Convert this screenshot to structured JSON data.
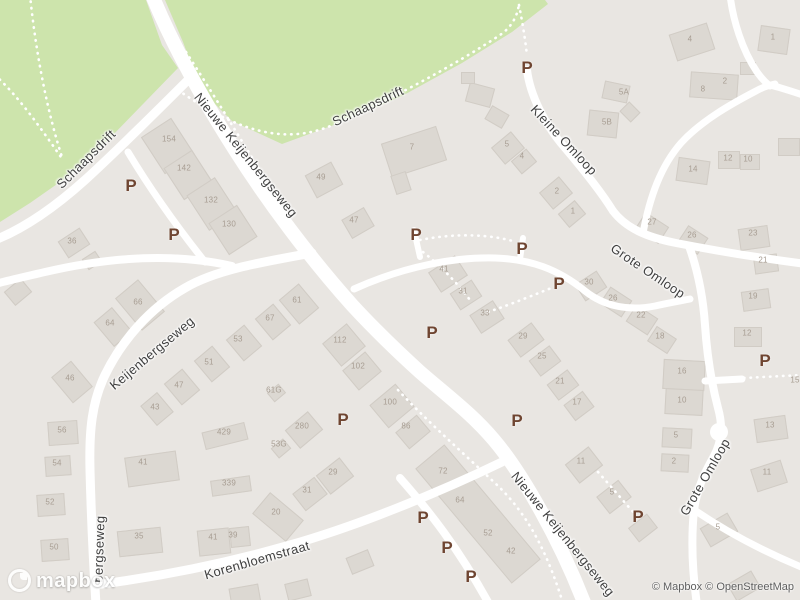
{
  "map": {
    "provider_logo": "mapbox",
    "attribution": "© Mapbox © OpenStreetMap",
    "colors": {
      "park": "#cde4ac",
      "background": "#e9e6e2",
      "road": "#ffffff",
      "building": "#dcd8d2",
      "building_outline": "#d1ccc5",
      "parking_icon": "#6f4531",
      "street_label": "#3f3f3f",
      "house_number": "#a79d92",
      "attribution": "#5f5f5f"
    },
    "streets": [
      {
        "t": "Schaapsdrift",
        "x": 86,
        "y": 159,
        "r": -45,
        "s": 13
      },
      {
        "t": "Nieuwe Keijenbergseweg",
        "x": 246,
        "y": 155,
        "r": 51,
        "s": 13
      },
      {
        "t": "Schaapsdrift",
        "x": 368,
        "y": 106,
        "r": -25,
        "s": 13
      },
      {
        "t": "Kleine Omloop",
        "x": 564,
        "y": 140,
        "r": 47,
        "s": 13
      },
      {
        "t": "Grote Omloop",
        "x": 648,
        "y": 271,
        "r": 34,
        "s": 13
      },
      {
        "t": "Keijenbergseweg",
        "x": 152,
        "y": 353,
        "r": -40,
        "s": 13
      },
      {
        "t": "bergseweg",
        "x": 99,
        "y": 549,
        "r": -88,
        "s": 13
      },
      {
        "t": "Korenbloemstraat",
        "x": 257,
        "y": 560,
        "r": -16,
        "s": 13
      },
      {
        "t": "Nieuwe Keijenbergseweg",
        "x": 563,
        "y": 534,
        "r": 51,
        "s": 13
      },
      {
        "t": "Grote Omloop",
        "x": 705,
        "y": 477,
        "r": -60,
        "s": 13
      }
    ],
    "parking_markers": [
      {
        "x": 131,
        "y": 186
      },
      {
        "x": 174,
        "y": 235
      },
      {
        "x": 527,
        "y": 68
      },
      {
        "x": 416,
        "y": 235
      },
      {
        "x": 522,
        "y": 249
      },
      {
        "x": 559,
        "y": 284
      },
      {
        "x": 432,
        "y": 333
      },
      {
        "x": 343,
        "y": 420
      },
      {
        "x": 517,
        "y": 421
      },
      {
        "x": 765,
        "y": 361
      },
      {
        "x": 638,
        "y": 517
      },
      {
        "x": 423,
        "y": 518
      },
      {
        "x": 447,
        "y": 548
      },
      {
        "x": 471,
        "y": 577
      }
    ],
    "house_numbers": [
      [
        "154",
        169,
        139
      ],
      [
        "142",
        184,
        168
      ],
      [
        "132",
        211,
        200
      ],
      [
        "130",
        229,
        224
      ],
      [
        "36",
        72,
        241
      ],
      [
        "49",
        321,
        177
      ],
      [
        "47",
        354,
        220
      ],
      [
        "7",
        412,
        147
      ],
      [
        "5A",
        624,
        92
      ],
      [
        "5B",
        607,
        122
      ],
      [
        "5",
        507,
        144
      ],
      [
        "4",
        522,
        156
      ],
      [
        "2",
        557,
        191
      ],
      [
        "1",
        573,
        211
      ],
      [
        "4",
        690,
        39
      ],
      [
        "1",
        773,
        37
      ],
      [
        "2",
        725,
        81
      ],
      [
        "8",
        703,
        89
      ],
      [
        "14",
        693,
        169
      ],
      [
        "12",
        728,
        158
      ],
      [
        "10",
        748,
        159
      ],
      [
        "27",
        652,
        222
      ],
      [
        "26",
        692,
        235
      ],
      [
        "23",
        753,
        233
      ],
      [
        "21",
        763,
        260
      ],
      [
        "19",
        753,
        296
      ],
      [
        "12",
        747,
        333
      ],
      [
        "26",
        613,
        298
      ],
      [
        "22",
        641,
        315
      ],
      [
        "18",
        660,
        336
      ],
      [
        "30",
        589,
        282
      ],
      [
        "41",
        444,
        269
      ],
      [
        "31",
        463,
        291
      ],
      [
        "33",
        485,
        313
      ],
      [
        "29",
        523,
        336
      ],
      [
        "25",
        542,
        356
      ],
      [
        "21",
        560,
        381
      ],
      [
        "17",
        577,
        402
      ],
      [
        "16",
        682,
        371
      ],
      [
        "10",
        682,
        400
      ],
      [
        "5",
        676,
        435
      ],
      [
        "2",
        674,
        461
      ],
      [
        "13",
        770,
        425
      ],
      [
        "11",
        767,
        472
      ],
      [
        "15",
        795,
        380
      ],
      [
        "5",
        718,
        527
      ],
      [
        "11",
        581,
        461
      ],
      [
        "5",
        612,
        492
      ],
      [
        "66",
        138,
        302
      ],
      [
        "64",
        110,
        323
      ],
      [
        "61",
        297,
        300
      ],
      [
        "67",
        270,
        318
      ],
      [
        "53",
        238,
        339
      ],
      [
        "51",
        209,
        362
      ],
      [
        "47",
        179,
        385
      ],
      [
        "43",
        155,
        407
      ],
      [
        "46",
        70,
        378
      ],
      [
        "56",
        62,
        430
      ],
      [
        "54",
        57,
        463
      ],
      [
        "52",
        50,
        502
      ],
      [
        "50",
        54,
        547
      ],
      [
        "41",
        143,
        462
      ],
      [
        "35",
        139,
        536
      ],
      [
        "41",
        213,
        537
      ],
      [
        "39",
        233,
        535
      ],
      [
        "20",
        276,
        512
      ],
      [
        "29",
        333,
        472
      ],
      [
        "31",
        307,
        490
      ],
      [
        "112",
        340,
        340
      ],
      [
        "102",
        358,
        366
      ],
      [
        "100",
        390,
        402
      ],
      [
        "86",
        406,
        426
      ],
      [
        "72",
        443,
        471
      ],
      [
        "64",
        460,
        500
      ],
      [
        "52",
        488,
        533
      ],
      [
        "42",
        511,
        551
      ],
      [
        "429",
        224,
        432
      ],
      [
        "339",
        229,
        483
      ],
      [
        "280",
        302,
        426
      ],
      [
        "53G",
        279,
        444
      ],
      [
        "61G",
        274,
        390
      ]
    ],
    "buildings": [
      [
        168,
        146,
        36,
        44,
        -33
      ],
      [
        188,
        175,
        34,
        38,
        -33
      ],
      [
        212,
        204,
        34,
        42,
        -33
      ],
      [
        233,
        230,
        34,
        38,
        -33
      ],
      [
        74,
        243,
        26,
        20,
        -33
      ],
      [
        92,
        260,
        16,
        13,
        -33
      ],
      [
        18,
        292,
        22,
        18,
        -40
      ],
      [
        324,
        180,
        30,
        26,
        -28
      ],
      [
        358,
        223,
        26,
        22,
        -30
      ],
      [
        414,
        152,
        58,
        36,
        -18
      ],
      [
        401,
        183,
        16,
        20,
        -18
      ],
      [
        480,
        95,
        26,
        20,
        15
      ],
      [
        497,
        117,
        20,
        16,
        30
      ],
      [
        468,
        78,
        14,
        12,
        0
      ],
      [
        616,
        92,
        26,
        18,
        12
      ],
      [
        603,
        124,
        30,
        26,
        6
      ],
      [
        630,
        112,
        16,
        14,
        45
      ],
      [
        692,
        42,
        40,
        28,
        -18
      ],
      [
        774,
        40,
        30,
        26,
        8
      ],
      [
        714,
        86,
        48,
        26,
        4
      ],
      [
        748,
        68,
        16,
        13,
        0
      ],
      [
        693,
        171,
        32,
        24,
        8
      ],
      [
        729,
        160,
        22,
        18,
        0
      ],
      [
        750,
        162,
        20,
        16,
        0
      ],
      [
        789,
        147,
        22,
        18,
        0
      ],
      [
        652,
        228,
        28,
        20,
        33
      ],
      [
        693,
        240,
        24,
        20,
        33
      ],
      [
        754,
        238,
        30,
        22,
        -8
      ],
      [
        766,
        264,
        24,
        18,
        -8
      ],
      [
        756,
        300,
        28,
        20,
        -8
      ],
      [
        748,
        337,
        28,
        20,
        0
      ],
      [
        616,
        302,
        26,
        20,
        33
      ],
      [
        642,
        320,
        26,
        20,
        33
      ],
      [
        662,
        340,
        24,
        18,
        33
      ],
      [
        591,
        286,
        26,
        20,
        -33
      ],
      [
        448,
        274,
        32,
        24,
        -33
      ],
      [
        466,
        295,
        26,
        20,
        -33
      ],
      [
        487,
        317,
        28,
        22,
        -33
      ],
      [
        526,
        340,
        30,
        22,
        -37
      ],
      [
        545,
        361,
        26,
        20,
        -37
      ],
      [
        563,
        385,
        26,
        20,
        -37
      ],
      [
        579,
        406,
        24,
        20,
        -37
      ],
      [
        684,
        375,
        42,
        30,
        3
      ],
      [
        684,
        402,
        38,
        26,
        3
      ],
      [
        677,
        438,
        30,
        20,
        3
      ],
      [
        675,
        463,
        28,
        18,
        3
      ],
      [
        771,
        429,
        32,
        24,
        -8
      ],
      [
        769,
        476,
        32,
        24,
        -18
      ],
      [
        719,
        530,
        32,
        22,
        -30
      ],
      [
        744,
        586,
        28,
        20,
        -30
      ],
      [
        584,
        465,
        30,
        24,
        -38
      ],
      [
        614,
        497,
        28,
        22,
        -38
      ],
      [
        643,
        528,
        24,
        18,
        -38
      ],
      [
        140,
        305,
        30,
        42,
        -40
      ],
      [
        113,
        327,
        24,
        32,
        -40
      ],
      [
        72,
        382,
        26,
        34,
        -40
      ],
      [
        63,
        433,
        30,
        24,
        -4
      ],
      [
        58,
        466,
        26,
        20,
        -4
      ],
      [
        51,
        505,
        28,
        22,
        -4
      ],
      [
        55,
        550,
        28,
        22,
        -4
      ],
      [
        299,
        304,
        26,
        32,
        -40
      ],
      [
        273,
        322,
        24,
        28,
        -40
      ],
      [
        244,
        343,
        24,
        28,
        -40
      ],
      [
        212,
        364,
        24,
        28,
        -40
      ],
      [
        182,
        387,
        24,
        28,
        -40
      ],
      [
        157,
        409,
        22,
        26,
        -40
      ],
      [
        225,
        436,
        44,
        18,
        -14
      ],
      [
        304,
        430,
        30,
        24,
        -40
      ],
      [
        281,
        448,
        16,
        13,
        -40
      ],
      [
        276,
        393,
        15,
        12,
        -40
      ],
      [
        231,
        486,
        40,
        16,
        -8
      ],
      [
        152,
        469,
        52,
        30,
        -8
      ],
      [
        140,
        542,
        44,
        26,
        -6
      ],
      [
        214,
        542,
        32,
        26,
        -6
      ],
      [
        240,
        537,
        20,
        20,
        -6
      ],
      [
        278,
        517,
        28,
        44,
        -50
      ],
      [
        335,
        476,
        30,
        24,
        -38
      ],
      [
        310,
        494,
        28,
        22,
        -38
      ],
      [
        344,
        345,
        32,
        30,
        -40
      ],
      [
        362,
        371,
        30,
        26,
        -40
      ],
      [
        392,
        406,
        34,
        30,
        -40
      ],
      [
        413,
        432,
        28,
        22,
        -40
      ],
      [
        478,
        514,
        38,
        150,
        -40
      ],
      [
        245,
        596,
        30,
        20,
        -10
      ],
      [
        298,
        590,
        24,
        18,
        -14
      ],
      [
        360,
        562,
        24,
        18,
        -22
      ],
      [
        508,
        148,
        26,
        22,
        -40
      ],
      [
        524,
        161,
        20,
        17,
        -40
      ],
      [
        556,
        193,
        26,
        22,
        -40
      ],
      [
        572,
        214,
        22,
        18,
        -40
      ]
    ]
  }
}
